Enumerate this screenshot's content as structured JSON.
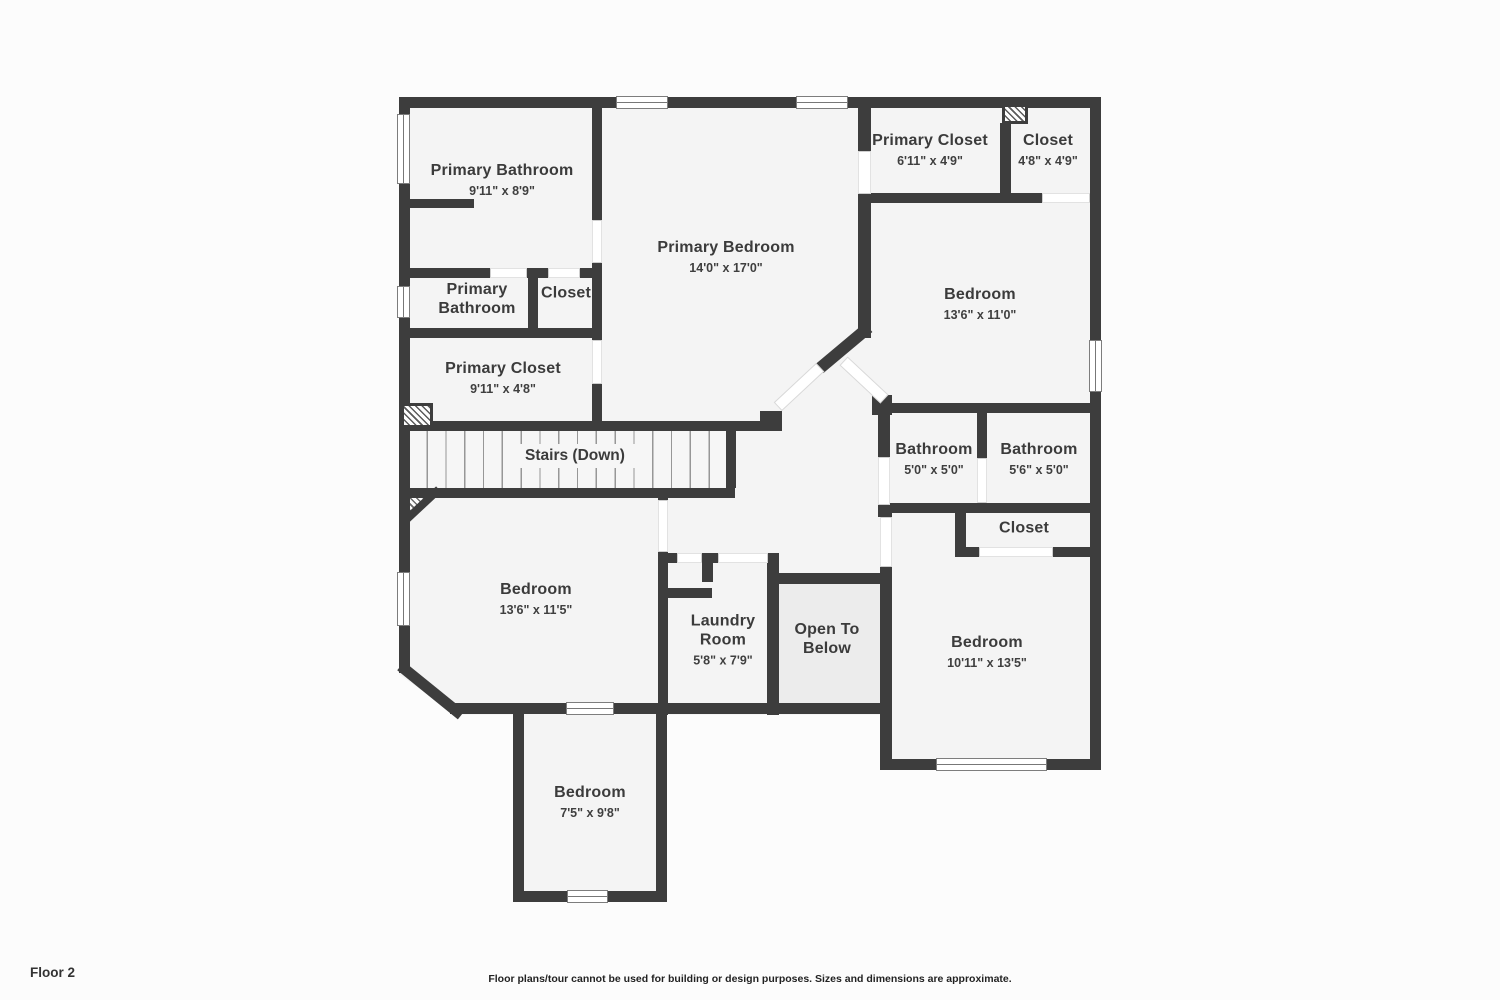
{
  "title": "Floor plan - Floor 2",
  "colors": {
    "wall": "#3d3d3d",
    "floor": "#f4f4f4",
    "open_to_below_fill": "#ececec",
    "background": "#fcfcfc"
  },
  "stairs": {
    "label": "Stairs (Down)"
  },
  "rooms": [
    {
      "name": "Primary Bathroom",
      "dims": "9'11\" x 8'9\""
    },
    {
      "name": "Primary Bedroom",
      "dims": "14'0\" x 17'0\""
    },
    {
      "name": "Primary Closet",
      "dims": "6'11\" x 4'9\""
    },
    {
      "name": "Closet",
      "dims": "4'8\" x 4'9\""
    },
    {
      "name": "Bedroom",
      "dims": "13'6\" x 11'0\""
    },
    {
      "name": "Primary Bathroom",
      "dims": ""
    },
    {
      "name": "Closet",
      "dims": ""
    },
    {
      "name": "Primary Closet",
      "dims": "9'11\" x 4'8\""
    },
    {
      "name": "Bathroom",
      "dims": "5'0\" x 5'0\""
    },
    {
      "name": "Bathroom",
      "dims": "5'6\" x 5'0\""
    },
    {
      "name": "Closet",
      "dims": ""
    },
    {
      "name": "Bedroom",
      "dims": "13'6\" x 11'5\""
    },
    {
      "name": "Laundry Room",
      "dims": "5'8\" x 7'9\""
    },
    {
      "name": "Open To Below",
      "dims": ""
    },
    {
      "name": "Bedroom",
      "dims": "10'11\" x 13'5\""
    },
    {
      "name": "Bedroom",
      "dims": "7'5\" x 9'8\""
    }
  ],
  "footer": {
    "floor_label": "Floor 2",
    "disclaimer": "Floor plans/tour cannot be used for building or design purposes. Sizes and dimensions are approximate."
  }
}
